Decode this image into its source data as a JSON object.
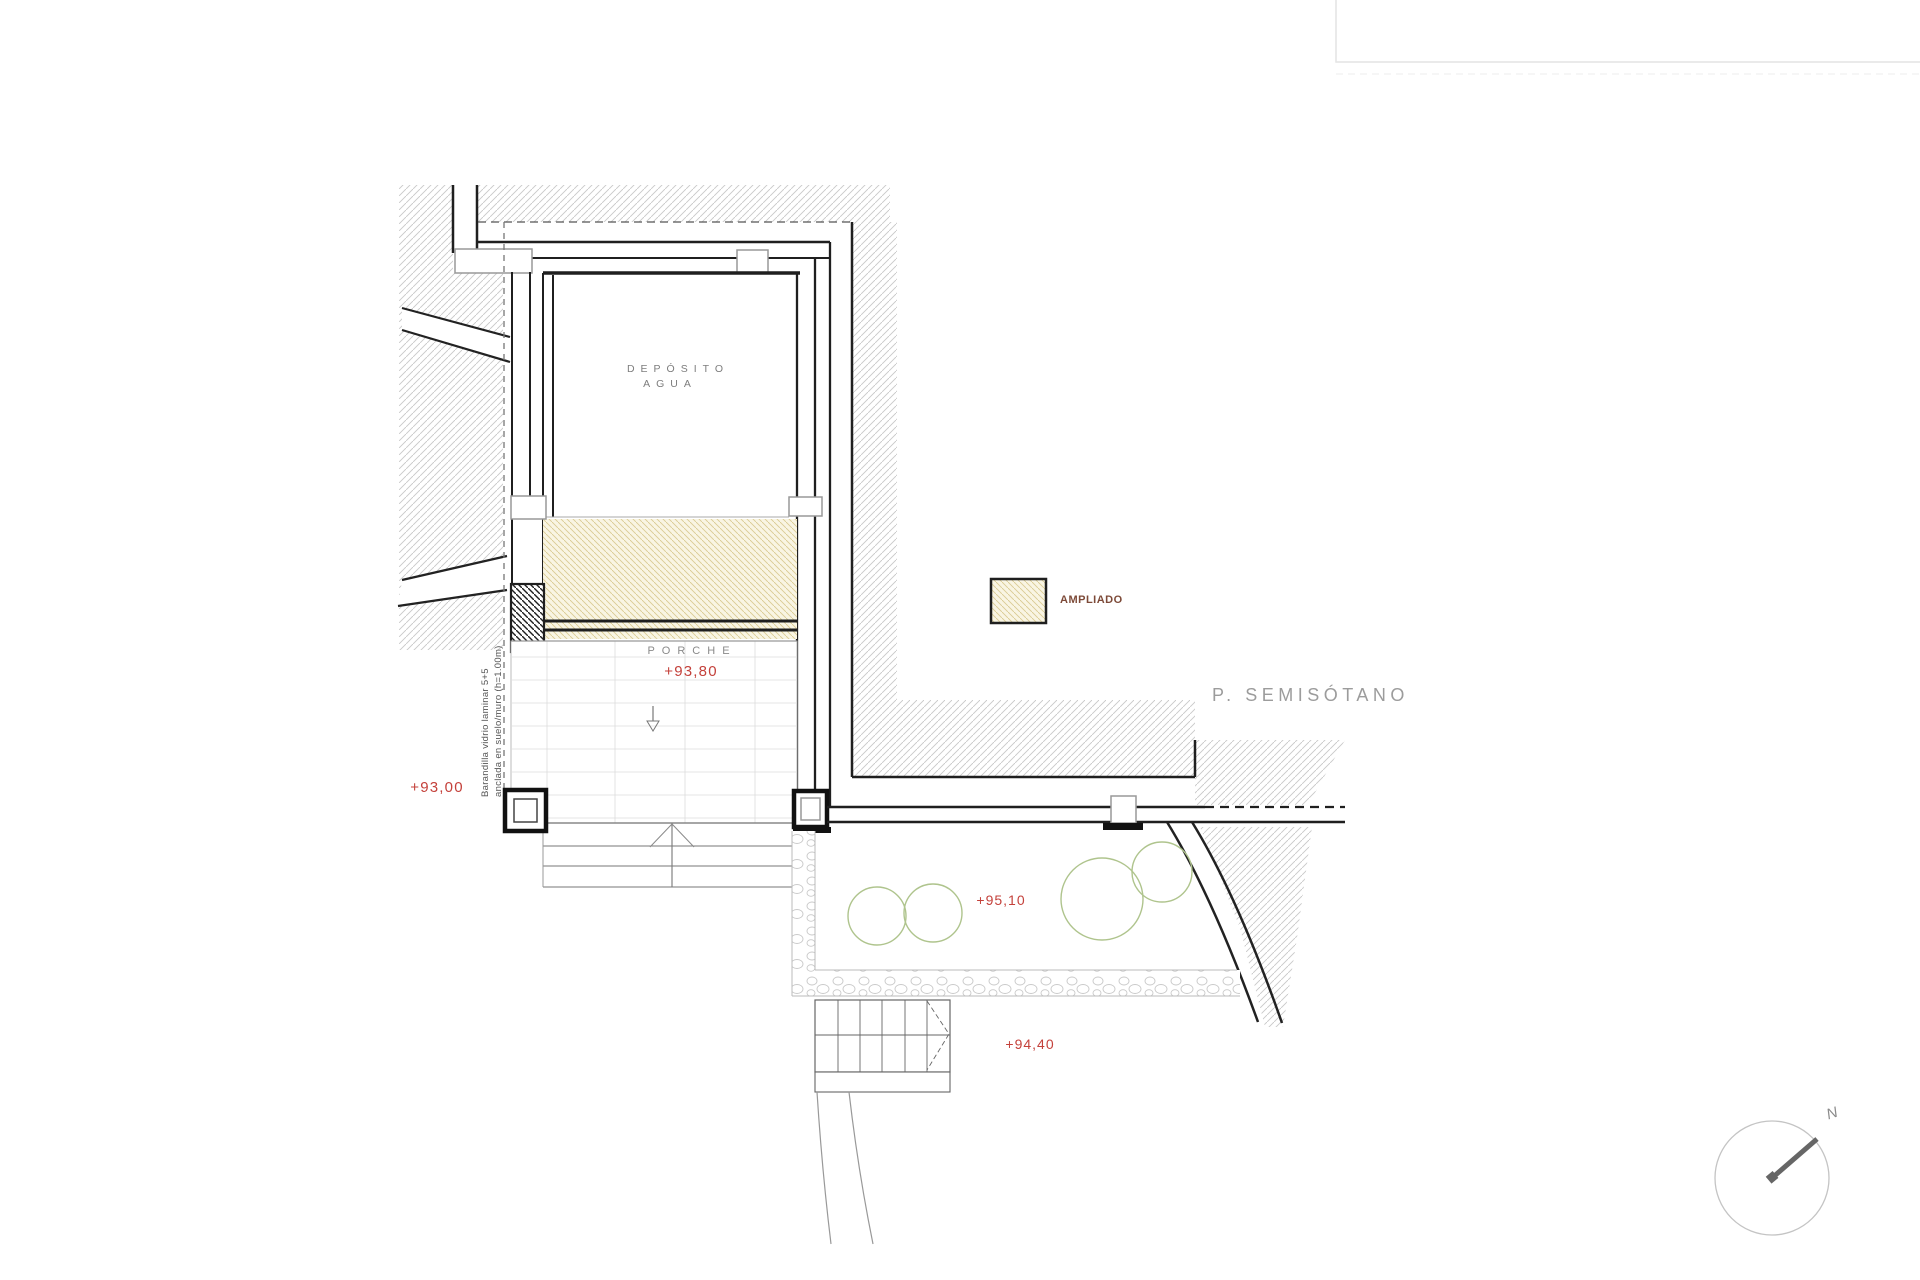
{
  "title": "P.  SEMISÓTANO",
  "room": {
    "line1": "DEPÓSITO",
    "line2": "AGUA"
  },
  "porch": {
    "label": "PORCHE",
    "level": "+93,80"
  },
  "levels": {
    "ground_left": "+93,00",
    "terrace": "+95,10",
    "stairs": "+94,40"
  },
  "note": {
    "line1": "Barandilla vidrio laminar 5+5",
    "line2": "anclada en suelo/muro (h=1.00m)"
  },
  "legend": {
    "label": "AMPLIADO"
  },
  "compass": {
    "label": "N"
  },
  "colors": {
    "level_red": "#c4413b",
    "ampliado_fill": "#f9f5e3",
    "ampliado_hatch": "#d9cb92",
    "legend_text": "#7d4a38",
    "tree_green": "#afc48d",
    "terrain_hatch": "#c8c8c8",
    "title_gray": "#9c9c9c",
    "wall_black": "#1f1f1f"
  }
}
